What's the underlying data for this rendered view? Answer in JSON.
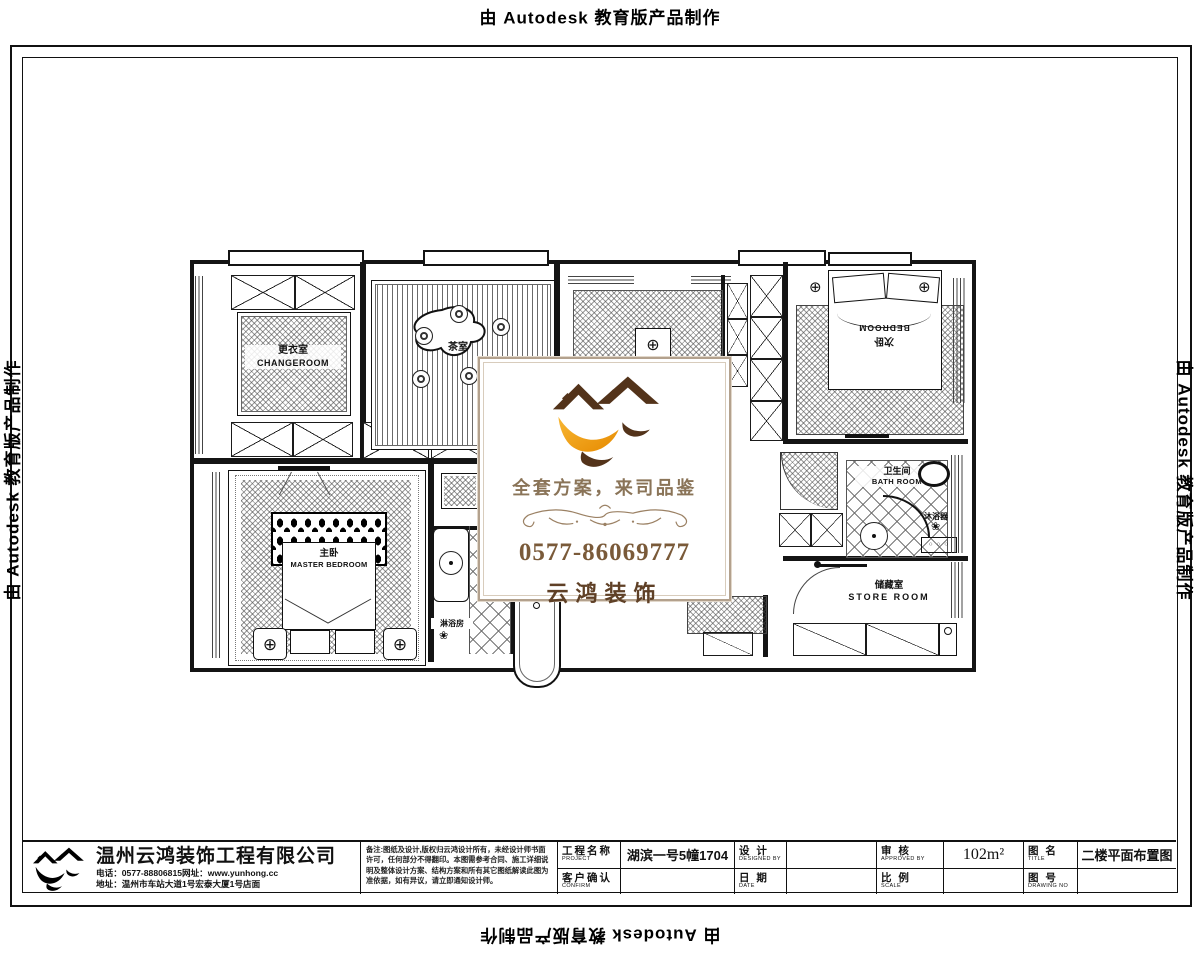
{
  "page": {
    "autodesk_notice": "由 Autodesk 教育版产品制作"
  },
  "stamp": {
    "logo_icon": "twin-roofs-swallow-logo",
    "slogan": "全套方案，来司品鉴",
    "phone": "0577-86069777",
    "brand": "云鸿装饰"
  },
  "plan": {
    "rooms": {
      "changeroom": {
        "cn": "更衣室",
        "en": "CHANGEROOM"
      },
      "tearoom": {
        "cn": "茶室"
      },
      "bedroom2": {
        "cn": "次卧",
        "en": "BEDROOM"
      },
      "master": {
        "cn": "主卧",
        "en": "MASTER BEDROOM"
      },
      "shower": {
        "cn": "淋浴房"
      },
      "bath": {
        "cn": "卫生间",
        "en": "BATH ROOM"
      },
      "bath_heater": {
        "cn": "沐浴器"
      },
      "store": {
        "cn": "储藏室",
        "en": "STORE  ROOM"
      }
    },
    "symbols": {
      "ceiling_light": "⊕",
      "shower_flower": "❀",
      "knobs": "○ ○ ○"
    }
  },
  "titleblock": {
    "company": "温州云鸿装饰工程有限公司",
    "phone_line": "电话：0577-88806815网址：www.yunhong.cc",
    "address_line": "地址：温州市车站大道1号宏泰大厦1号店面",
    "notes": "备注:图纸及设计,版权归云鸿设计所有，未经设计师书面许可，任何部分不得翻印。本图需参考合同、施工详细说明及整体设计方案、结构方案和所有其它图纸解读此图为准依据，如有异议，请立即通知设计师。",
    "fields": {
      "project_label_cn": "工程名称",
      "project_label_en": "PROJECT",
      "project_value": "湖滨一号5幢1704",
      "confirm_label_cn": "客户确认",
      "confirm_label_en": "CONFIRM",
      "confirm_value": "",
      "design_label_cn": "设 计",
      "design_label_en": "DESIGNED BY",
      "design_value": "",
      "date_label_cn": "日 期",
      "date_label_en": "DATE",
      "date_value": "",
      "approve_label_cn": "审 核",
      "approve_label_en": "APPROVED BY",
      "approve_value": "102m²",
      "scale_label_cn": "比 例",
      "scale_label_en": "SCALE",
      "scale_value": "",
      "title_label_cn": "图 名",
      "title_label_en": "TITLE",
      "title_value": "二楼平面布置图",
      "drawno_label_cn": "图 号",
      "drawno_label_en": "DRAWING NO",
      "drawno_value": ""
    }
  }
}
